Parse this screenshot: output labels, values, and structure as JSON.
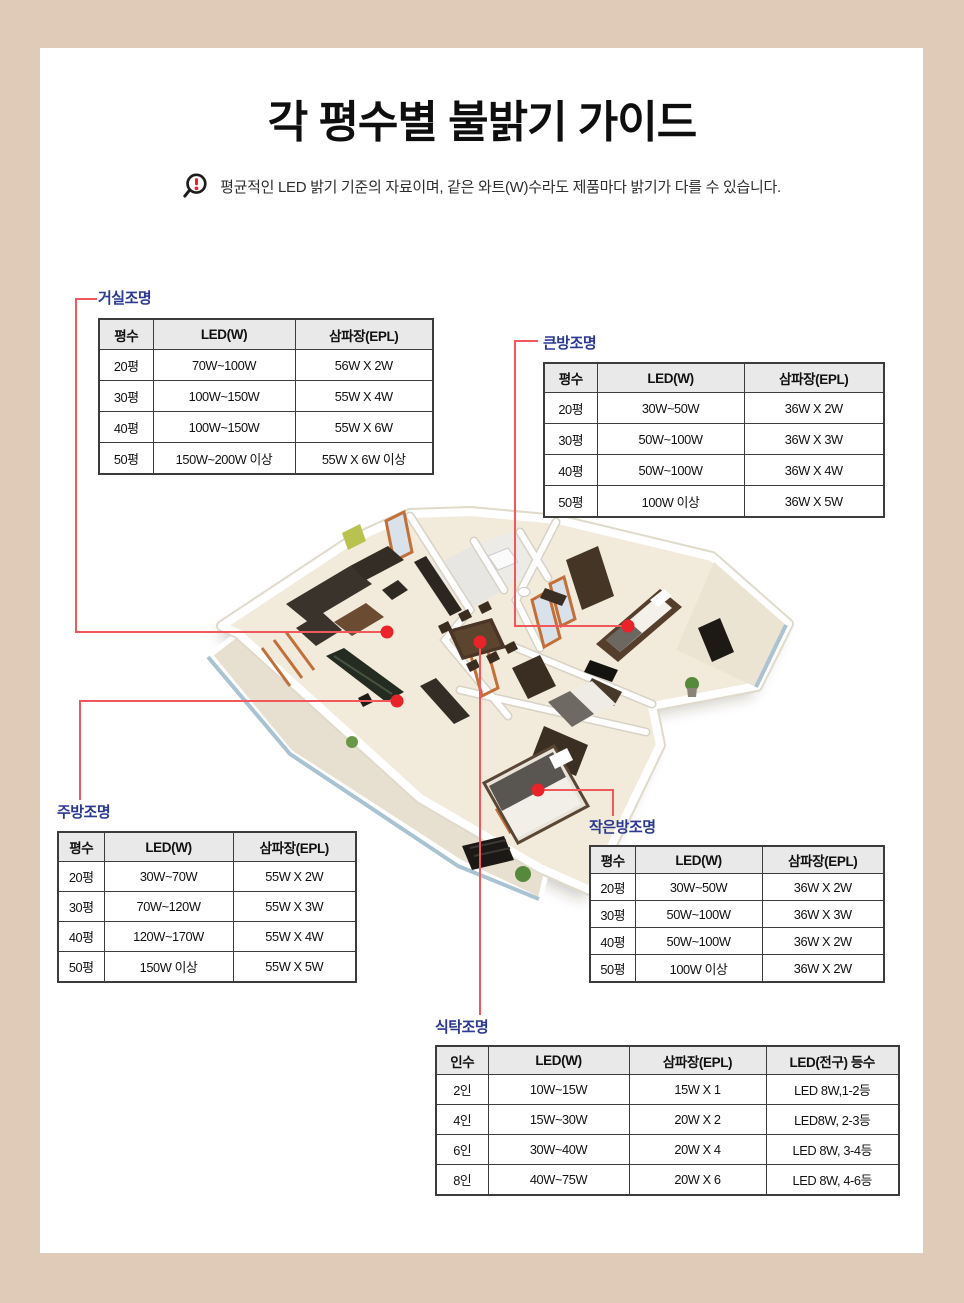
{
  "page": {
    "title": "각 평수별 불밝기 가이드",
    "notice": "평균적인 LED 밝기 기준의 자료이며, 같은 와트(W)수라도 제품마다 밝기가 다를 수 있습니다."
  },
  "colors": {
    "page_background": "#dfcbb7",
    "card_background": "#ffffff",
    "label_blue": "#2b3990",
    "connector_red": "#f1585c",
    "dot_red": "#e8232a",
    "table_header_bg": "#e9e9e9",
    "table_border": "#3c3c3c",
    "notice_exclamation_red": "#e32228"
  },
  "tables": [
    {
      "id": "living",
      "label": "거실조명",
      "headers": [
        "평수",
        "LED(W)",
        "삼파장(EPL)"
      ],
      "rows": [
        [
          "20평",
          "70W~100W",
          "56W X 2W"
        ],
        [
          "30평",
          "100W~150W",
          "55W X 4W"
        ],
        [
          "40평",
          "100W~150W",
          "55W X 6W"
        ],
        [
          "50평",
          "150W~200W 이상",
          "55W X 6W 이상"
        ]
      ]
    },
    {
      "id": "bigroom",
      "label": "큰방조명",
      "headers": [
        "평수",
        "LED(W)",
        "삼파장(EPL)"
      ],
      "rows": [
        [
          "20평",
          "30W~50W",
          "36W X 2W"
        ],
        [
          "30평",
          "50W~100W",
          "36W X 3W"
        ],
        [
          "40평",
          "50W~100W",
          "36W X 4W"
        ],
        [
          "50평",
          "100W 이상",
          "36W X 5W"
        ]
      ]
    },
    {
      "id": "kitchen",
      "label": "주방조명",
      "headers": [
        "평수",
        "LED(W)",
        "삼파장(EPL)"
      ],
      "rows": [
        [
          "20평",
          "30W~70W",
          "55W X 2W"
        ],
        [
          "30평",
          "70W~120W",
          "55W X 3W"
        ],
        [
          "40평",
          "120W~170W",
          "55W X 4W"
        ],
        [
          "50평",
          "150W 이상",
          "55W X 5W"
        ]
      ]
    },
    {
      "id": "smallroom",
      "label": "작은방조명",
      "headers": [
        "평수",
        "LED(W)",
        "삼파장(EPL)"
      ],
      "rows": [
        [
          "20평",
          "30W~50W",
          "36W X 2W"
        ],
        [
          "30평",
          "50W~100W",
          "36W X 3W"
        ],
        [
          "40평",
          "50W~100W",
          "36W X 2W"
        ],
        [
          "50평",
          "100W 이상",
          "36W X 2W"
        ]
      ]
    },
    {
      "id": "dining",
      "label": "식탁조명",
      "headers": [
        "인수",
        "LED(W)",
        "삼파장(EPL)",
        "LED(전구) 등수"
      ],
      "rows": [
        [
          "2인",
          "10W~15W",
          "15W X 1",
          "LED 8W,1-2등"
        ],
        [
          "4인",
          "15W~30W",
          "20W X 2",
          "LED8W, 2-3등"
        ],
        [
          "6인",
          "30W~40W",
          "20W X 4",
          "LED 8W, 3-4등"
        ],
        [
          "8인",
          "40W~75W",
          "20W X 6",
          "LED 8W, 4-6등"
        ]
      ]
    }
  ],
  "floorplan": {
    "markers": [
      "living-room",
      "kitchen",
      "dining-table",
      "master-bedroom",
      "small-bedroom"
    ]
  }
}
